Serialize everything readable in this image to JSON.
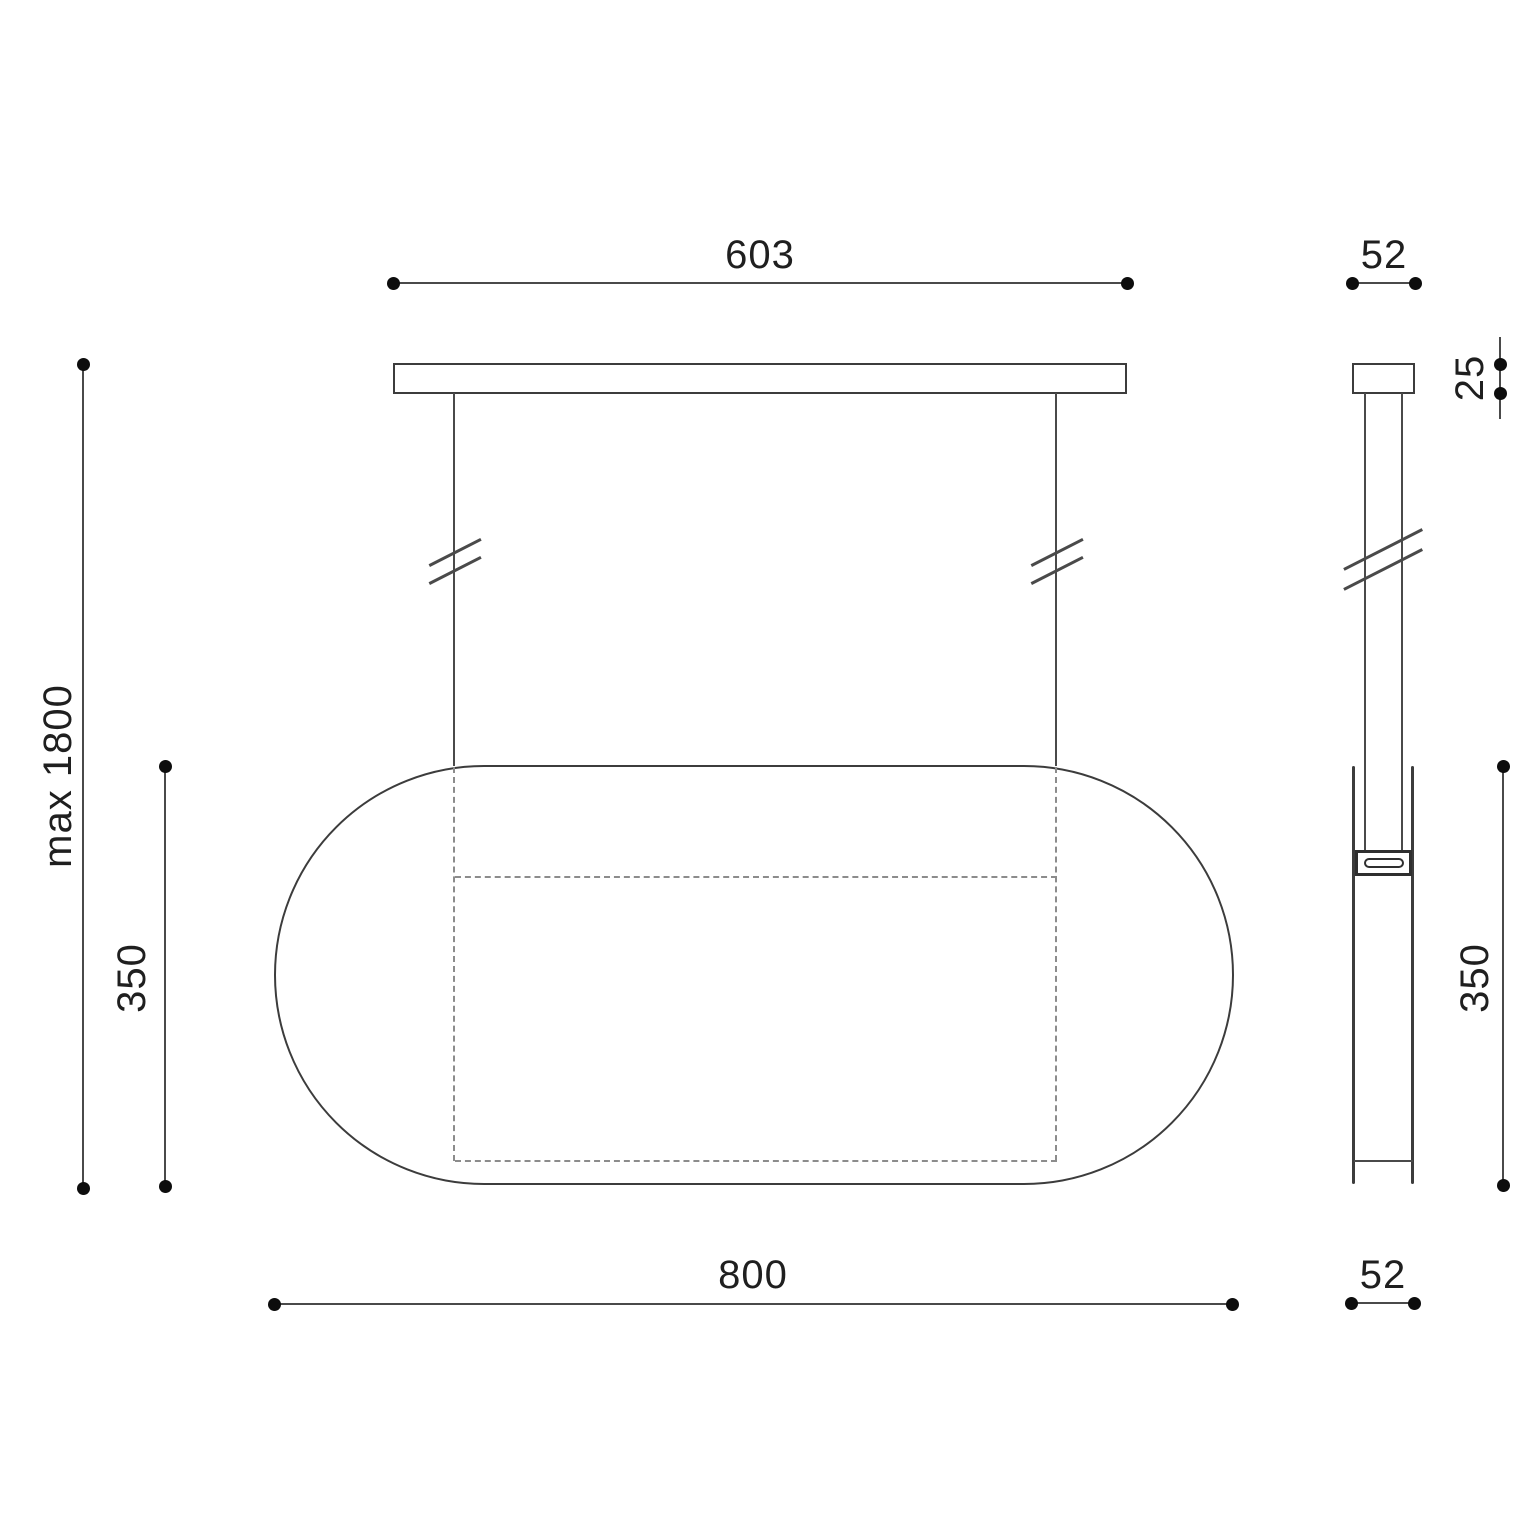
{
  "front_view": {
    "canopy_width_label": "603",
    "overall_height_label": "max 1800",
    "shade_height_label": "350",
    "shade_width_label": "800"
  },
  "side_view": {
    "canopy_width_label": "52",
    "canopy_height_label": "25",
    "shade_height_label": "350",
    "shade_width_label": "52"
  },
  "colors": {
    "structure_line": "#3c3c3c",
    "dimension_line": "#4a4a4a",
    "dashed_line": "#8c8c8c",
    "dot": "#0d0d0d",
    "text": "#1f1f1f",
    "background": "#ffffff"
  }
}
